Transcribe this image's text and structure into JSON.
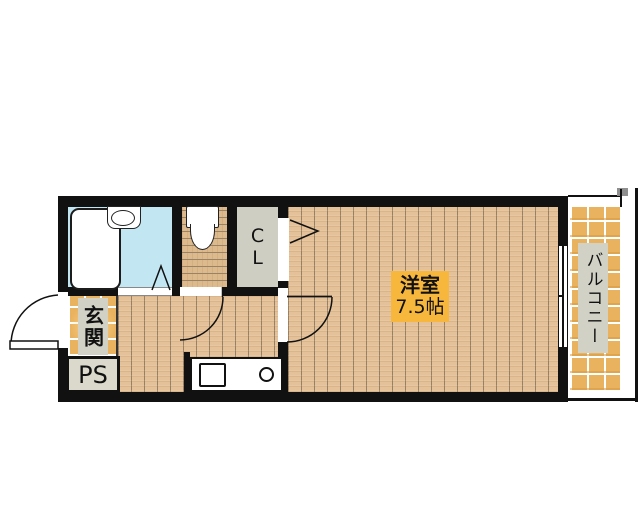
{
  "plan_type": "apartment-floor-plan",
  "rooms": {
    "entrance": {
      "label": "玄関"
    },
    "pipe_space": {
      "label": "PS"
    },
    "closet": {
      "label": "CL"
    },
    "western_room": {
      "label": "洋室",
      "area": "7.5帖"
    },
    "balcony": {
      "label": "バルコニー"
    }
  },
  "colors": {
    "wall": "#111111",
    "bathroom_floor": "#c2e7f3",
    "closet_fill": "#cfcec3",
    "label_gray": "#d2d1c6",
    "room_label_bg": "#f6b73c",
    "wood_base": "#e4c198",
    "tile_base": "#e9b25f",
    "ps_fill": "#dad9cb"
  }
}
